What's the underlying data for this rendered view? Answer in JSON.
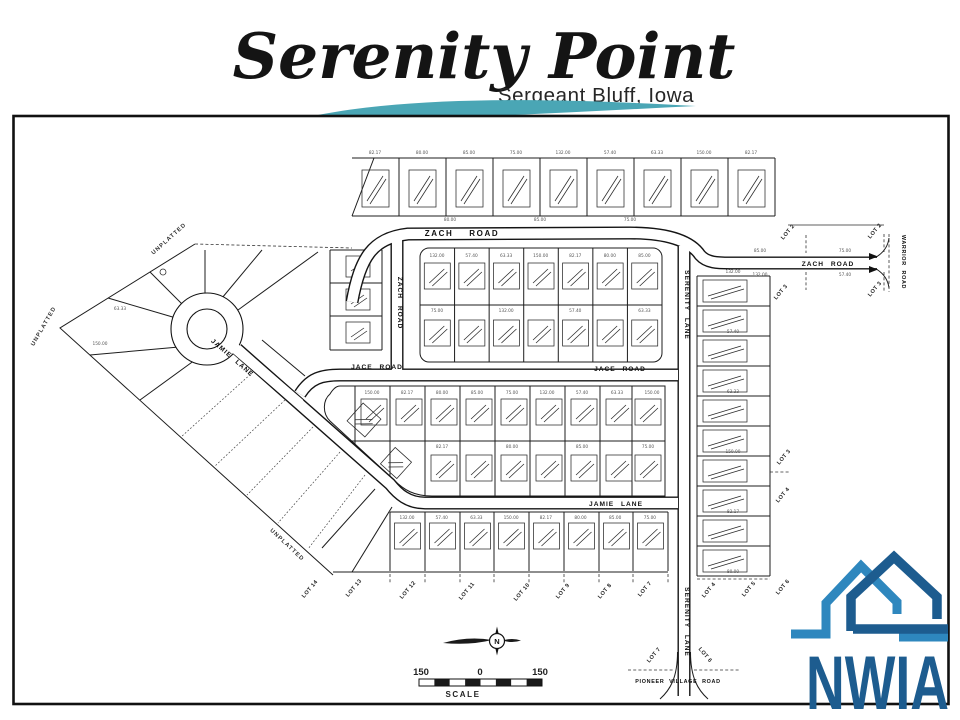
{
  "header": {
    "title": "Serenity Point",
    "subtitle": "Sergeant Bluff, Iowa"
  },
  "swoosh": {
    "teal": "#4aa6b5",
    "green": "#7cb942"
  },
  "map": {
    "roads": {
      "zach_top": "ZACH ROAD",
      "zach_vertical": "ZACH ROAD",
      "zach_east": "ZACH ROAD",
      "jace_west": "JACE ROAD",
      "jace_east": "JACE ROAD",
      "jamie_diagonal": "JAMIE LANE",
      "jamie_horizontal": "JAMIE LANE",
      "serenity_upper": "SERENITY LANE",
      "serenity_lower": "SERENITY LANE",
      "warrior": "WARRIOR ROAD",
      "pioneer": "PIONEER VILLAGE ROAD"
    },
    "unplatted_labels": [
      "UNPLATTED",
      "UNPLATTED",
      "UNPLATTED"
    ],
    "bottom_lot_labels": [
      "LOT 14",
      "LOT 13",
      "LOT 12",
      "LOT 11",
      "LOT 10",
      "LOT 9",
      "LOT 8",
      "LOT 7"
    ],
    "east_zach_lot_labels": [
      "LOT 2",
      "LOT 2",
      "LOT 3",
      "LOT 3"
    ],
    "right_lot_labels": [
      "LOT 3",
      "LOT 4"
    ],
    "se_corner_lot_labels": [
      "LOT 4",
      "LOT 5",
      "LOT 6"
    ],
    "serenity_end_lot_labels": [
      "LOT 7",
      "LOT 6"
    ],
    "compass_label": "N",
    "scale": {
      "left": "150",
      "zero": "0",
      "right": "150",
      "caption": "SCALE"
    },
    "dim_sample": [
      "82.17",
      "80.00",
      "85.00",
      "75.00",
      "132.00",
      "57.40",
      "63.33",
      "150.00"
    ]
  },
  "logo": {
    "text": "NWIA",
    "light_blue": "#2e87be",
    "dark_blue": "#1d5c8f"
  }
}
